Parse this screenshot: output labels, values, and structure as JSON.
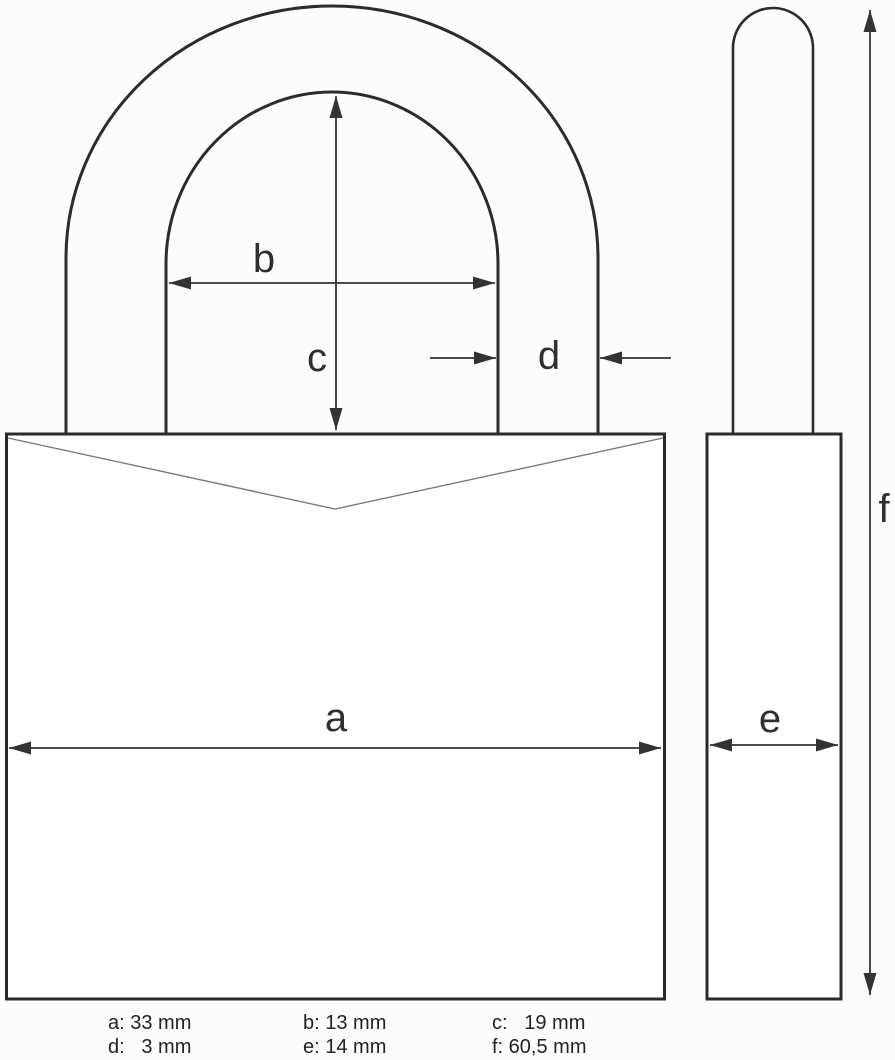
{
  "page": {
    "background": "#fcfcfc",
    "description": "Technical drawing of a padlock with dimension annotations (front view and side view)"
  },
  "colors": {
    "outline": "#2b2b2b",
    "dimension_line": "#333333",
    "chevron_line": "#787878",
    "label_text": "#2f2f2f"
  },
  "diagram": {
    "dimension_labels": {
      "a": "a",
      "b": "b",
      "c": "c",
      "d": "d",
      "e": "e",
      "f": "f"
    },
    "legend": {
      "items": [
        {
          "id": "a",
          "text": "a: 33 mm",
          "value_mm": 33
        },
        {
          "id": "b",
          "text": "b: 13 mm",
          "value_mm": 13
        },
        {
          "id": "c",
          "text": "c:   19 mm",
          "value_mm": 19
        },
        {
          "id": "d",
          "text": "d:   3 mm",
          "value_mm": 3
        },
        {
          "id": "e",
          "text": "e: 14 mm",
          "value_mm": 14
        },
        {
          "id": "f",
          "text": "f: 60,5 mm",
          "value_mm": 60.5
        }
      ]
    }
  }
}
